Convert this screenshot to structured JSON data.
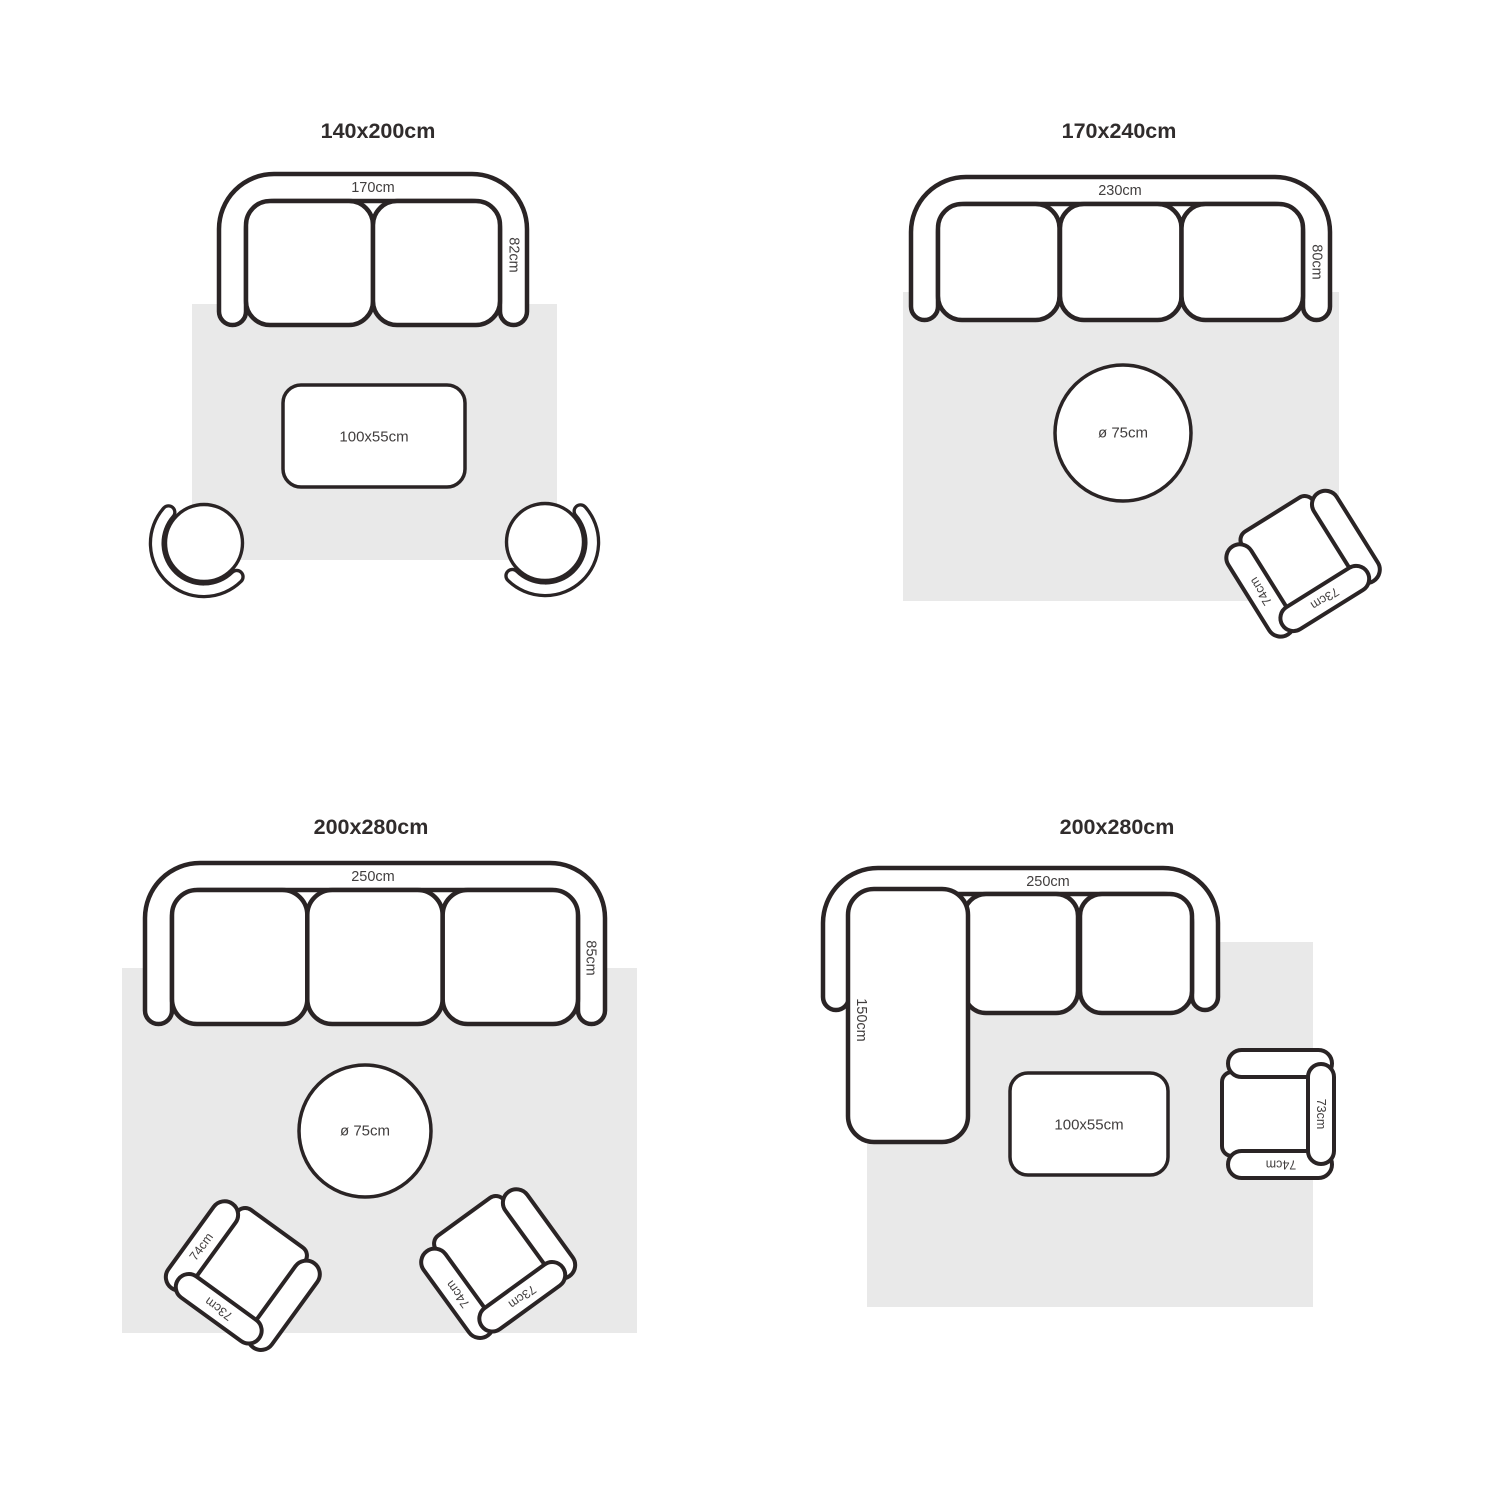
{
  "diagram": "rug-size-guide",
  "colors": {
    "background": "#ffffff",
    "line": "#2a2425",
    "rug_fill": "#e9e9e9",
    "title_text": "#302c2c",
    "label_text": "#413e3e"
  },
  "quadrants": [
    {
      "title": "140x200cm",
      "sofa": {
        "type": "2-seat-sofa",
        "width_label": "170cm",
        "depth_label": "82cm"
      },
      "coffee_table": {
        "shape": "rectangular",
        "size_label": "100x55cm"
      },
      "chairs": [
        {
          "type": "round-chair"
        },
        {
          "type": "round-chair"
        }
      ]
    },
    {
      "title": "170x240cm",
      "sofa": {
        "type": "3-seat-sofa",
        "width_label": "230cm",
        "depth_label": "80cm"
      },
      "coffee_table": {
        "shape": "round",
        "size_label": "ø 75cm"
      },
      "chair": {
        "type": "armchair",
        "arm_label": "74cm",
        "back_label": "73cm"
      }
    },
    {
      "title": "200x280cm",
      "sofa": {
        "type": "3-seat-sofa",
        "width_label": "250cm",
        "depth_label": "85cm"
      },
      "coffee_table": {
        "shape": "round",
        "size_label": "ø 75cm"
      },
      "chairs": [
        {
          "type": "armchair",
          "arm_label": "74cm",
          "back_label": "73cm"
        },
        {
          "type": "armchair",
          "arm_label": "74cm",
          "back_label": "73cm"
        }
      ]
    },
    {
      "title": "200x280cm",
      "sofa": {
        "type": "sectional-sofa-chaise",
        "width_label": "250cm",
        "chaise_label": "150cm"
      },
      "coffee_table": {
        "shape": "rectangular",
        "size_label": "100x55cm"
      },
      "chair": {
        "type": "armchair",
        "arm_label": "74cm",
        "back_label": "73cm"
      }
    }
  ]
}
